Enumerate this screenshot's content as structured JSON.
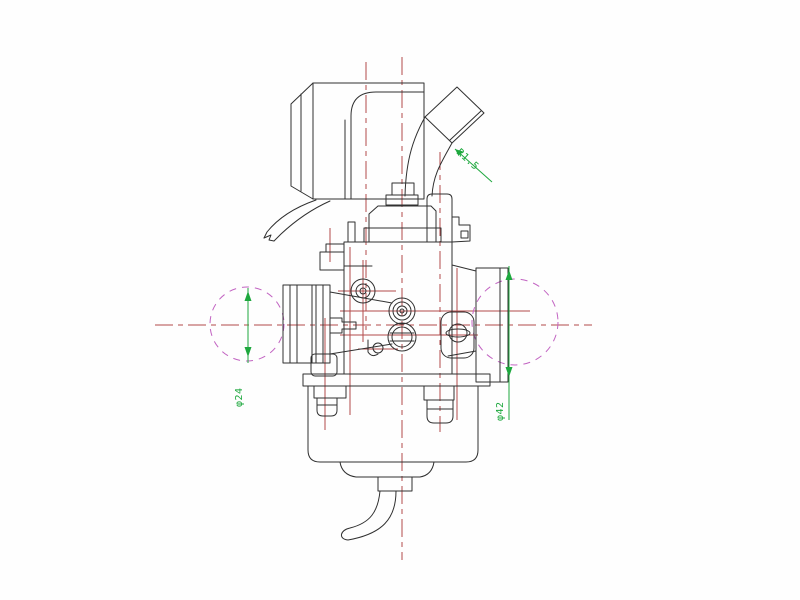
{
  "drawing": {
    "type": "cad-technical-drawing",
    "subject": "carburetor side view",
    "background": "#fefefe",
    "colors": {
      "outline": "#303030",
      "centerline": "#b34a4a",
      "dimension": "#1ea83e",
      "phantom_circle": "#c264c2"
    },
    "dimensions": {
      "left_diameter": {
        "label": "φ24"
      },
      "right_diameter": {
        "label": "φ42"
      },
      "radius_callout": {
        "label": "R1.5"
      }
    }
  }
}
